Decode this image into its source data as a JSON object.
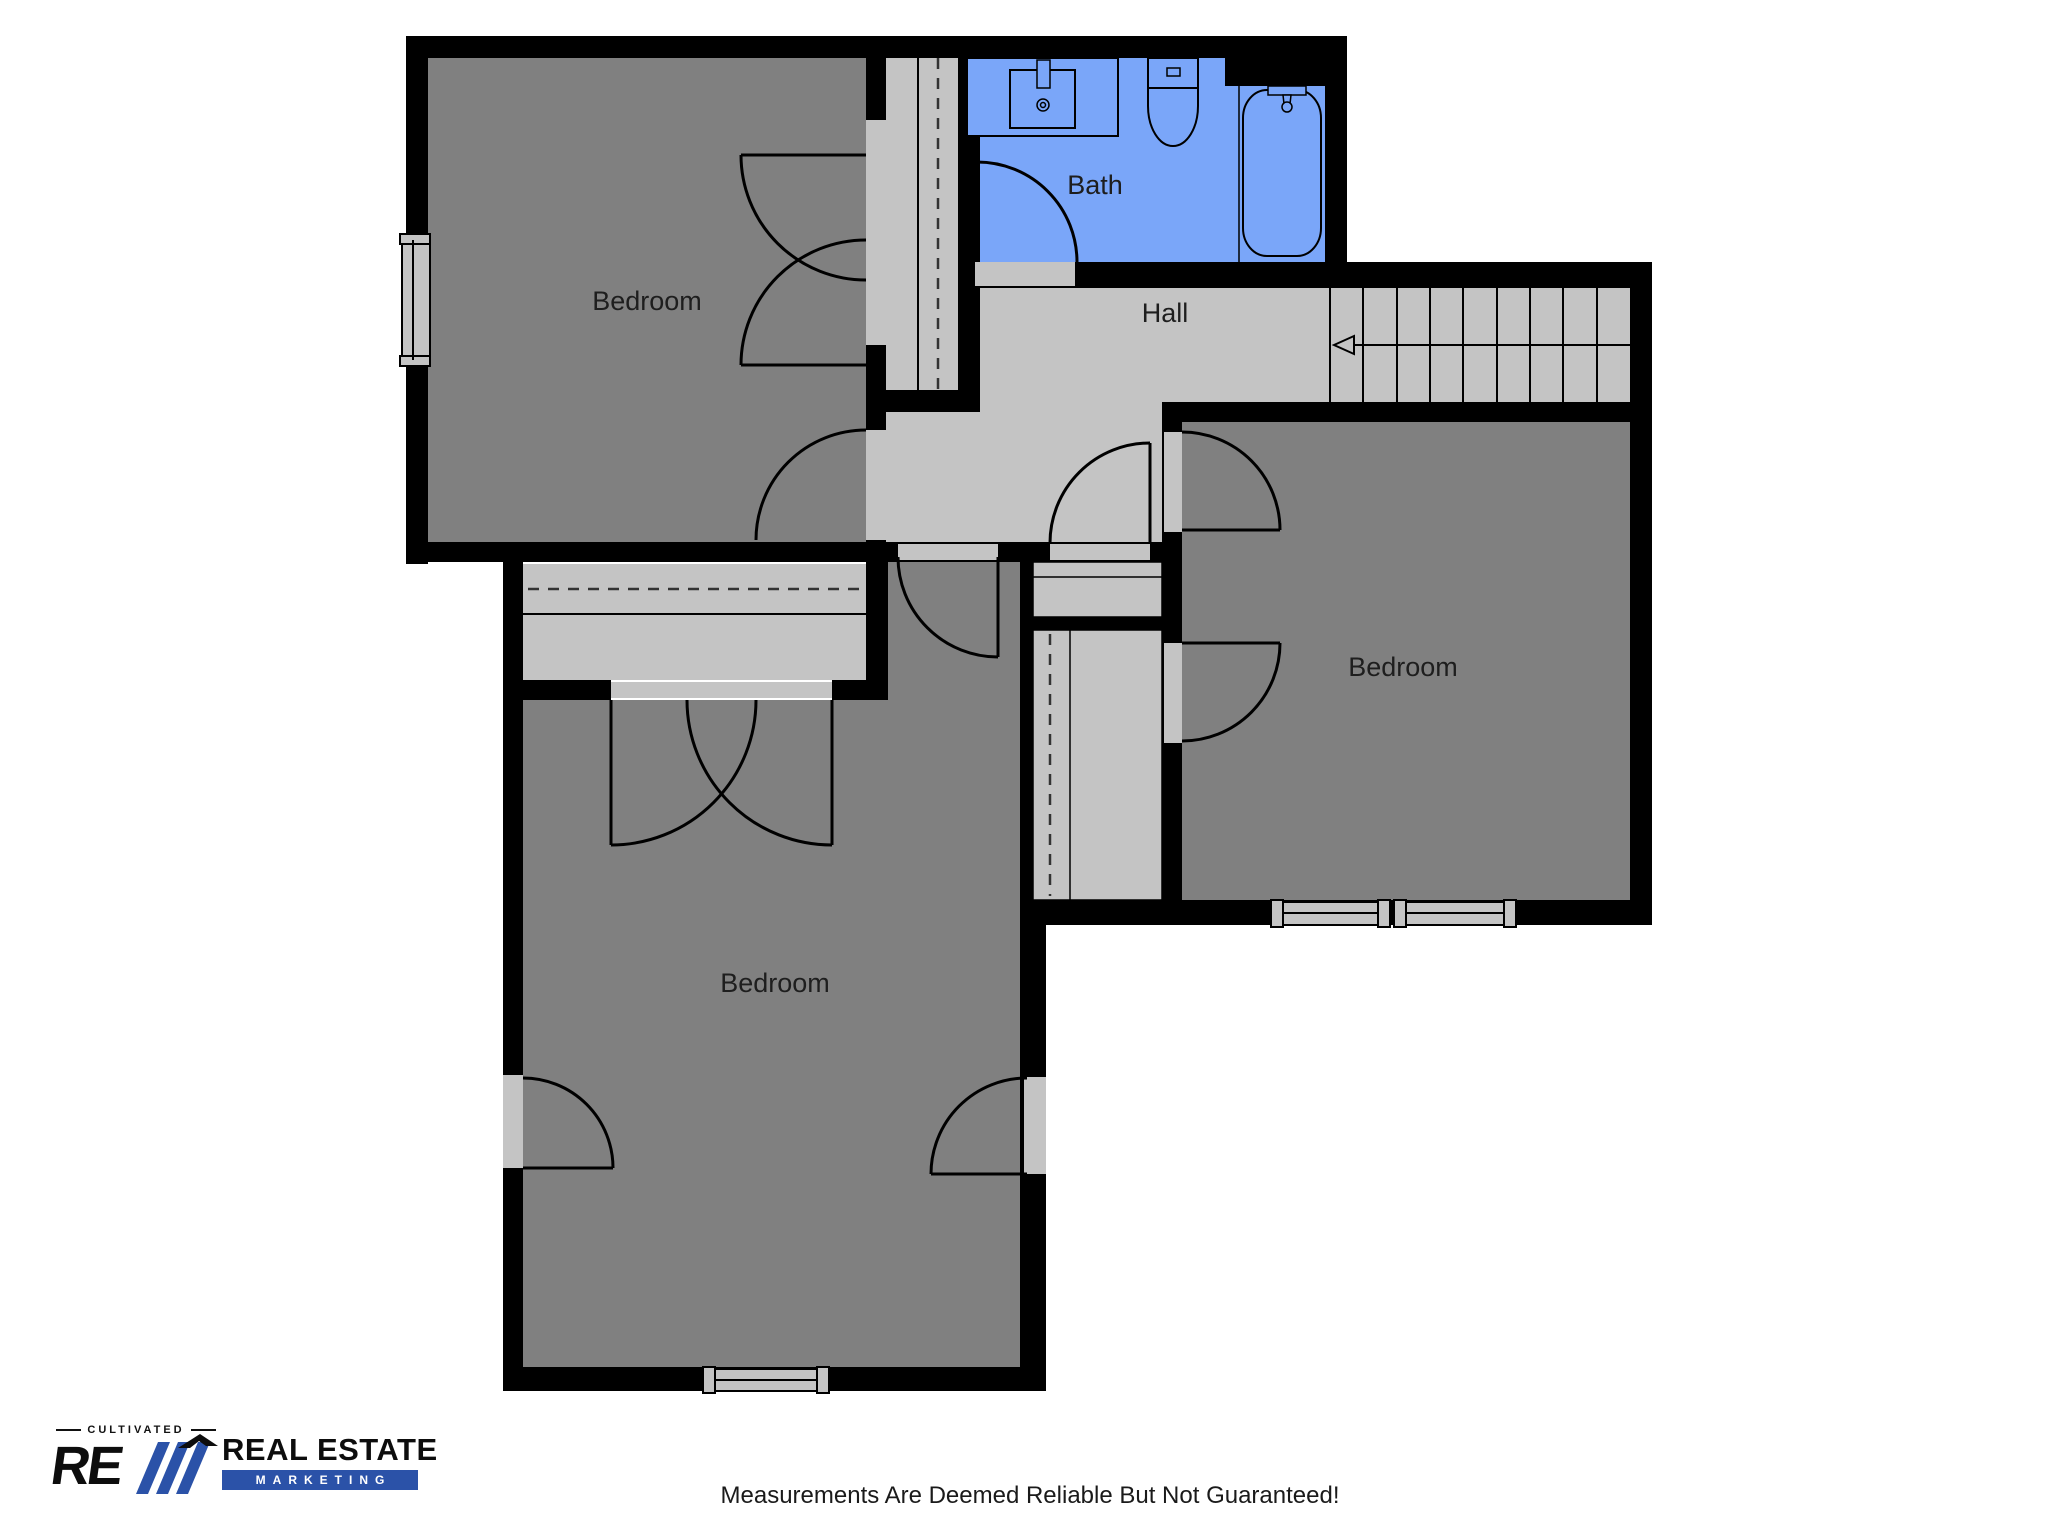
{
  "rooms": [
    {
      "id": "bedroom-top-left",
      "label": "Bedroom"
    },
    {
      "id": "bath",
      "label": "Bath"
    },
    {
      "id": "hall",
      "label": "Hall"
    },
    {
      "id": "bedroom-right",
      "label": "Bedroom"
    },
    {
      "id": "bedroom-bottom-left",
      "label": "Bedroom"
    }
  ],
  "footer": {
    "disclaimer": "Measurements Are Deemed Reliable But Not Guaranteed!"
  },
  "logo": {
    "tagline": "CULTIVATED",
    "monogram": "RE",
    "line1": "REAL ESTATE",
    "line2": "MARKETING"
  },
  "colors": {
    "wall": "#000000",
    "room_fill": "#808080",
    "hall_fill": "#c4c4c4",
    "bath_fill": "#7aa6f9",
    "logo_blue": "#2b52a8"
  }
}
